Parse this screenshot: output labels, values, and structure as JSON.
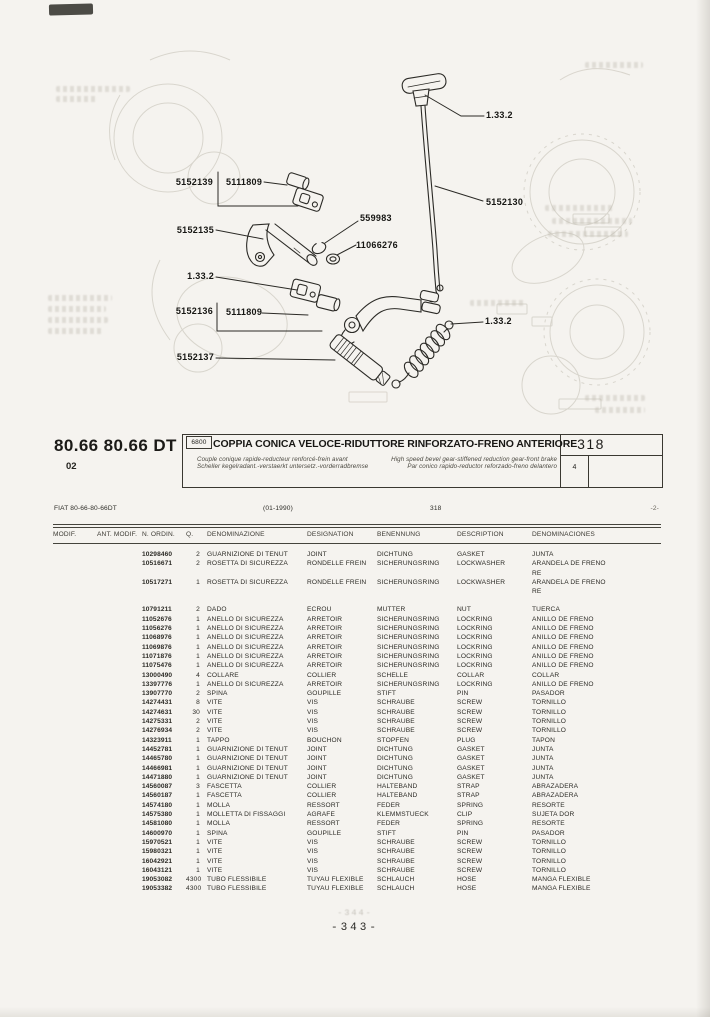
{
  "header": {
    "code": "80.66 80.66 DT",
    "code_sub": "02",
    "badge": "6800",
    "title": "COPPIA CONICA VELOCE-RIDUTTORE RINFORZATO-FRENO ANTERIORE",
    "sub_fr": "Couple conique rapide-reducteur renforcé-frein avant",
    "sub_de": "Scheller kegelradant.-verstaerkt untersetz.-vorderradbremse",
    "sub_en": "High speed bevel gear-stiffened reduction gear-front brake",
    "sub_es": "Par conico rapido-reductor reforzado-freno delantero",
    "page": "318",
    "sheet": "4"
  },
  "meta": {
    "model_line": "FIAT 80-66-80-66DT",
    "date_range": "(01-1990)",
    "page": "318",
    "sheet": "-2-"
  },
  "diagram": {
    "labels": [
      {
        "text": "5152139"
      },
      {
        "text": "5111809"
      },
      {
        "text": "1.33.2"
      },
      {
        "text": "5152130"
      },
      {
        "text": "559983"
      },
      {
        "text": "11066276"
      },
      {
        "text": "5152135"
      },
      {
        "text": "1.33.2"
      },
      {
        "text": "5152136"
      },
      {
        "text": "5111809"
      },
      {
        "text": "5152137"
      },
      {
        "text": "1.33.2"
      }
    ]
  },
  "table": {
    "headers": [
      "MODIF.",
      "ANT. MODIF.",
      "N. ORDIN.",
      "Q.",
      "DENOMINAZIONE",
      "DESIGNATION",
      "BENENNUNG",
      "DESCRIPTION",
      "DENOMINACIONES"
    ],
    "rows": [
      {
        "n": "10298460",
        "q": "2",
        "it": "GUARNIZIONE DI TENUT",
        "fr": "JOINT",
        "de": "DICHTUNG",
        "en": "GASKET",
        "es": "JUNTA"
      },
      {
        "n": "10516671",
        "q": "2",
        "it": "ROSETTA DI SICUREZZA",
        "fr": "RONDELLE FREIN",
        "de": "SICHERUNGSRING",
        "en": "LOCKWASHER",
        "es": "ARANDELA DE FRENO\nRE"
      },
      {
        "n": "10517271",
        "q": "1",
        "it": "ROSETTA DI SICUREZZA",
        "fr": "RONDELLE FREIN",
        "de": "SICHERUNGSRING",
        "en": "LOCKWASHER",
        "es": "ARANDELA DE FRENO\nRE"
      },
      {
        "n": "10791211",
        "q": "2",
        "it": "DADO",
        "fr": "ECROU",
        "de": "MUTTER",
        "en": "NUT",
        "es": "TUERCA",
        "gap": true
      },
      {
        "n": "11052676",
        "q": "1",
        "it": "ANELLO DI SICUREZZA",
        "fr": "ARRETOIR",
        "de": "SICHERUNGSRING",
        "en": "LOCKRING",
        "es": "ANILLO DE FRENO"
      },
      {
        "n": "11056276",
        "q": "1",
        "it": "ANELLO DI SICUREZZA",
        "fr": "ARRETOIR",
        "de": "SICHERUNGSRING",
        "en": "LOCKRING",
        "es": "ANILLO DE FRENO"
      },
      {
        "n": "11068976",
        "q": "1",
        "it": "ANELLO DI SICUREZZA",
        "fr": "ARRETOIR",
        "de": "SICHERUNGSRING",
        "en": "LOCKRING",
        "es": "ANILLO DE FRENO"
      },
      {
        "n": "11069876",
        "q": "1",
        "it": "ANELLO DI SICUREZZA",
        "fr": "ARRETOIR",
        "de": "SICHERUNGSRING",
        "en": "LOCKRING",
        "es": "ANILLO DE FRENO"
      },
      {
        "n": "11071876",
        "q": "1",
        "it": "ANELLO DI SICUREZZA",
        "fr": "ARRETOIR",
        "de": "SICHERUNGSRING",
        "en": "LOCKRING",
        "es": "ANILLO DE FRENO"
      },
      {
        "n": "11075476",
        "q": "1",
        "it": "ANELLO DI SICUREZZA",
        "fr": "ARRETOIR",
        "de": "SICHERUNGSRING",
        "en": "LOCKRING",
        "es": "ANILLO DE FRENO"
      },
      {
        "n": "13000490",
        "q": "4",
        "it": "COLLARE",
        "fr": "COLLIER",
        "de": "SCHELLE",
        "en": "COLLAR",
        "es": "COLLAR"
      },
      {
        "n": "13397776",
        "q": "1",
        "it": "ANELLO DI SICUREZZA",
        "fr": "ARRETOIR",
        "de": "SICHERUNGSRING",
        "en": "LOCKRING",
        "es": "ANILLO DE FRENO"
      },
      {
        "n": "13907770",
        "q": "2",
        "it": "SPINA",
        "fr": "GOUPILLE",
        "de": "STIFT",
        "en": "PIN",
        "es": "PASADOR"
      },
      {
        "n": "14274431",
        "q": "8",
        "it": "VITE",
        "fr": "VIS",
        "de": "SCHRAUBE",
        "en": "SCREW",
        "es": "TORNILLO"
      },
      {
        "n": "14274631",
        "q": "30",
        "it": "VITE",
        "fr": "VIS",
        "de": "SCHRAUBE",
        "en": "SCREW",
        "es": "TORNILLO"
      },
      {
        "n": "14275331",
        "q": "2",
        "it": "VITE",
        "fr": "VIS",
        "de": "SCHRAUBE",
        "en": "SCREW",
        "es": "TORNILLO"
      },
      {
        "n": "14276934",
        "q": "2",
        "it": "VITE",
        "fr": "VIS",
        "de": "SCHRAUBE",
        "en": "SCREW",
        "es": "TORNILLO"
      },
      {
        "n": "14323911",
        "q": "1",
        "it": "TAPPO",
        "fr": "BOUCHON",
        "de": "STOPFEN",
        "en": "PLUG",
        "es": "TAPON"
      },
      {
        "n": "14452781",
        "q": "1",
        "it": "GUARNIZIONE DI TENUT",
        "fr": "JOINT",
        "de": "DICHTUNG",
        "en": "GASKET",
        "es": "JUNTA"
      },
      {
        "n": "14465780",
        "q": "1",
        "it": "GUARNIZIONE DI TENUT",
        "fr": "JOINT",
        "de": "DICHTUNG",
        "en": "GASKET",
        "es": "JUNTA"
      },
      {
        "n": "14466981",
        "q": "1",
        "it": "GUARNIZIONE DI TENUT",
        "fr": "JOINT",
        "de": "DICHTUNG",
        "en": "GASKET",
        "es": "JUNTA"
      },
      {
        "n": "14471880",
        "q": "1",
        "it": "GUARNIZIONE DI TENUT",
        "fr": "JOINT",
        "de": "DICHTUNG",
        "en": "GASKET",
        "es": "JUNTA"
      },
      {
        "n": "14560087",
        "q": "3",
        "it": "FASCETTA",
        "fr": "COLLIER",
        "de": "HALTEBAND",
        "en": "STRAP",
        "es": "ABRAZADERA"
      },
      {
        "n": "14560187",
        "q": "1",
        "it": "FASCETTA",
        "fr": "COLLIER",
        "de": "HALTEBAND",
        "en": "STRAP",
        "es": "ABRAZADERA"
      },
      {
        "n": "14574180",
        "q": "1",
        "it": "MOLLA",
        "fr": "RESSORT",
        "de": "FEDER",
        "en": "SPRING",
        "es": "RESORTE"
      },
      {
        "n": "14575380",
        "q": "1",
        "it": "MOLLETTA DI FISSAGGI",
        "fr": "AGRAFE",
        "de": "KLEMMSTUECK",
        "en": "CLIP",
        "es": "SUJETA DOR"
      },
      {
        "n": "14581080",
        "q": "1",
        "it": "MOLLA",
        "fr": "RESSORT",
        "de": "FEDER",
        "en": "SPRING",
        "es": "RESORTE"
      },
      {
        "n": "14600970",
        "q": "1",
        "it": "SPINA",
        "fr": "GOUPILLE",
        "de": "STIFT",
        "en": "PIN",
        "es": "PASADOR"
      },
      {
        "n": "15970521",
        "q": "1",
        "it": "VITE",
        "fr": "VIS",
        "de": "SCHRAUBE",
        "en": "SCREW",
        "es": "TORNILLO"
      },
      {
        "n": "15980321",
        "q": "1",
        "it": "VITE",
        "fr": "VIS",
        "de": "SCHRAUBE",
        "en": "SCREW",
        "es": "TORNILLO"
      },
      {
        "n": "16042921",
        "q": "1",
        "it": "VITE",
        "fr": "VIS",
        "de": "SCHRAUBE",
        "en": "SCREW",
        "es": "TORNILLO"
      },
      {
        "n": "16043121",
        "q": "1",
        "it": "VITE",
        "fr": "VIS",
        "de": "SCHRAUBE",
        "en": "SCREW",
        "es": "TORNILLO"
      },
      {
        "n": "19053082",
        "q": "4300",
        "it": "TUBO FLESSIBILE",
        "fr": "TUYAU FLEXIBLE",
        "de": "SCHLAUCH",
        "en": "HOSE",
        "es": "MANGA FLEXIBLE"
      },
      {
        "n": "19053382",
        "q": "4300",
        "it": "TUBO FLESSIBILE",
        "fr": "TUYAU FLEXIBLE",
        "de": "SCHLAUCH",
        "en": "HOSE",
        "es": "MANGA FLEXIBLE"
      }
    ]
  },
  "footer": {
    "page_number": "-343-",
    "ghost_prev_page": "-344-"
  },
  "colors": {
    "paper": "#f5f3ef",
    "ink": "#24231f",
    "ghost": "#c2beb2"
  }
}
